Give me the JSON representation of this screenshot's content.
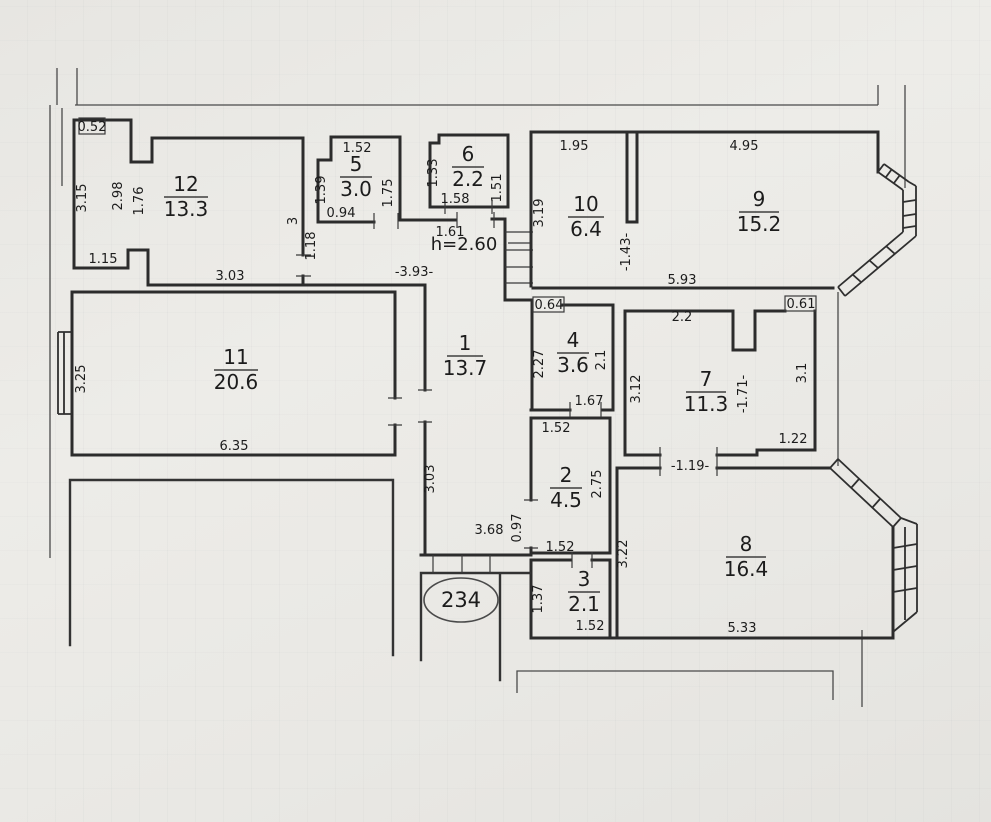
{
  "meta": {
    "apartment_number": "234",
    "ceiling_height": "h=2.60"
  },
  "rooms": [
    {
      "number": "1",
      "area": "13.7"
    },
    {
      "number": "2",
      "area": "4.5"
    },
    {
      "number": "3",
      "area": "2.1"
    },
    {
      "number": "4",
      "area": "3.6"
    },
    {
      "number": "5",
      "area": "3.0"
    },
    {
      "number": "6",
      "area": "2.2"
    },
    {
      "number": "7",
      "area": "11.3"
    },
    {
      "number": "8",
      "area": "16.4"
    },
    {
      "number": "9",
      "area": "15.2"
    },
    {
      "number": "10",
      "area": "6.4"
    },
    {
      "number": "11",
      "area": "20.6"
    },
    {
      "number": "12",
      "area": "13.3"
    }
  ],
  "dims": [
    "0.52",
    "1.52",
    "1.95",
    "4.95",
    "1.39",
    "1.75",
    "1.33",
    "1.51",
    "3.15",
    "2.98",
    "1.76",
    "0.94",
    "1.58",
    "1.61",
    "3",
    "1.18",
    "3.19",
    "-1.43-",
    "1.15",
    "3.03",
    "-3.93-",
    "5.93",
    "0.64",
    "2.2",
    "0.61",
    "3.25",
    "2.27",
    "2.1",
    "3.12",
    "-1.71-",
    "3.1",
    "1.67",
    "1.52",
    "2.75",
    "6.35",
    "3.03",
    "1.22",
    "-1.19-",
    "0.97",
    "3.22",
    "3.68",
    "1.52",
    "1.37",
    "1.52",
    "5.33"
  ]
}
